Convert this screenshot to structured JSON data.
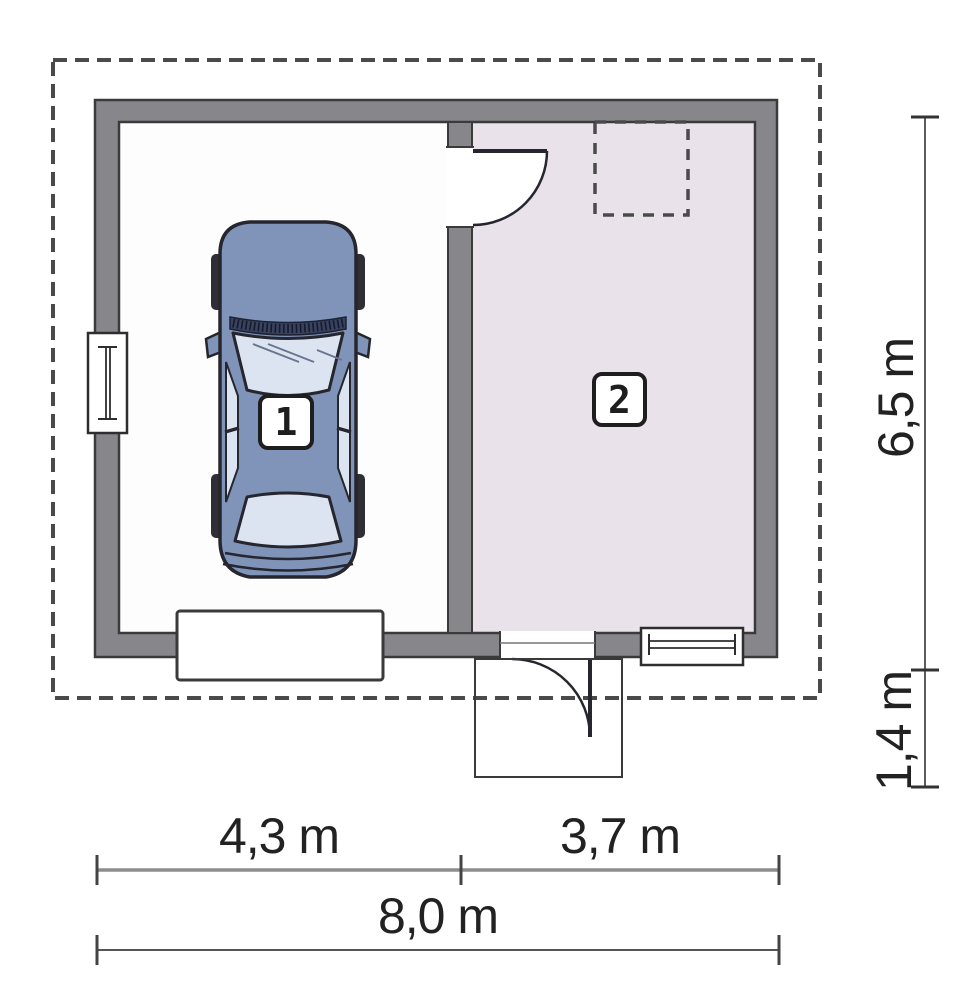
{
  "plan_type": "garage-floor-plan",
  "rooms": [
    {
      "label": "1"
    },
    {
      "label": "2"
    }
  ],
  "dimensions": {
    "bottom_segments": [
      {
        "label": "4,3 m",
        "meters": 4.3
      },
      {
        "label": "3,7 m",
        "meters": 3.7
      }
    ],
    "bottom_total": {
      "label": "8,0 m",
      "meters": 8.0
    },
    "right_segments": [
      {
        "label": "6,5 m",
        "meters": 6.5
      },
      {
        "label": "1,4 m",
        "meters": 1.4
      }
    ]
  },
  "colors": {
    "wall_fill": "#87878b",
    "wall_outline": "#3a3a3a",
    "room1_floor": "#fdfdfd",
    "room2_floor": "#e9e2ea",
    "dashed_outline": "#4a4a4a",
    "car_body": "#8094ba",
    "car_glass": "#dce4f2",
    "car_outline": "#26262e",
    "dimension_text": "#222222",
    "background": "#ffffff"
  }
}
